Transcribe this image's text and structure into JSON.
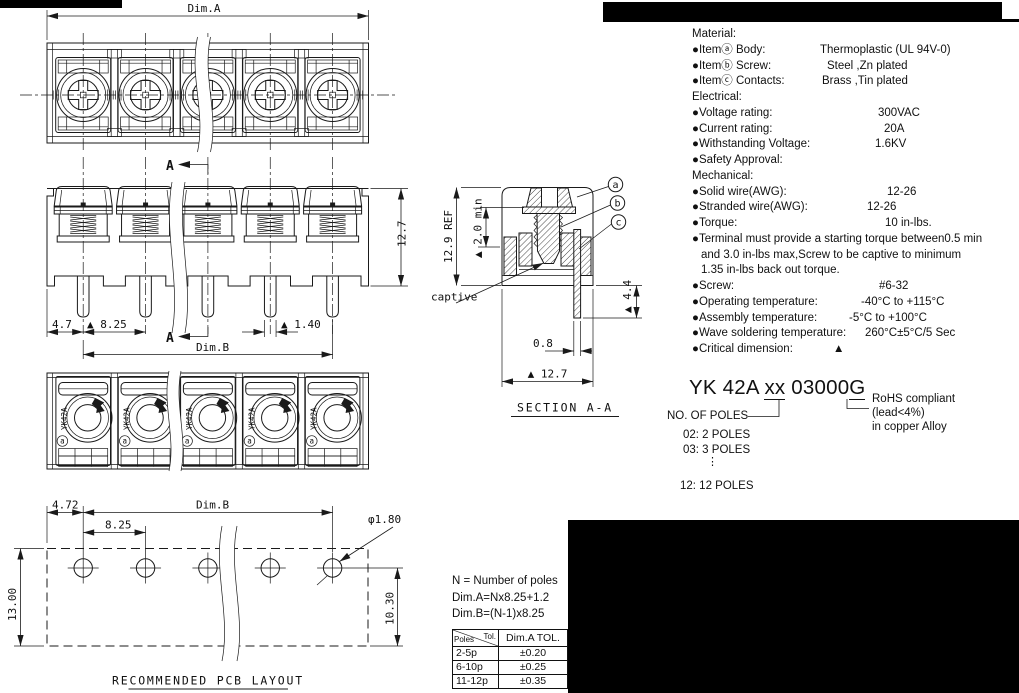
{
  "colors": {
    "line": "#1a1a1a",
    "background": "#ffffff",
    "redaction": "#000000"
  },
  "front_view": {
    "dim_a": "Dim.A"
  },
  "side_view": {
    "dim_left": "4.7",
    "dim_pitch": "▲ 8.25",
    "dim_pin": "▲ 1.40",
    "dim_b": "Dim.B",
    "dim_height": "12.7",
    "section_letter_top": "A",
    "section_letter_bottom": "A"
  },
  "bottom_view": {
    "marking": "YK42A",
    "callout_a": "a"
  },
  "section_view": {
    "title": "SECTION  A-A",
    "dim_ref": "12.9 REF",
    "dim_min": "▲ 2.0 min",
    "captive_label": "captive",
    "dim_pin_width": "0.8",
    "dim_width": "▲ 12.7",
    "dim_tail": "▲ 4.4",
    "callout_a": "a",
    "callout_b": "b",
    "callout_c": "c"
  },
  "pcb_view": {
    "title": "RECOMMENDED PCB LAYOUT",
    "dim_left": "4.72",
    "dim_b": "Dim.B",
    "dim_pitch": "8.25",
    "dim_hole": "φ1.80",
    "dim_height": "13.00",
    "dim_hole_edge": "10.30"
  },
  "specs": {
    "lines": [
      {
        "label": "Material:",
        "value": ""
      },
      {
        "label": "●Itemⓐ Body:",
        "value": "Thermoplastic (UL 94V-0)"
      },
      {
        "label": "●Itemⓑ Screw:",
        "value": "Steel ,Zn plated"
      },
      {
        "label": "●Itemⓒ Contacts:",
        "value": "Brass ,Tin plated"
      },
      {
        "label": "Electrical:",
        "value": ""
      },
      {
        "label": "●Voltage rating:",
        "value": "300VAC"
      },
      {
        "label": "●Current rating:",
        "value": "20A"
      },
      {
        "label": "●Withstanding Voltage:",
        "value": "1.6KV"
      },
      {
        "label": "●Safety Approval:",
        "value": ""
      },
      {
        "label": "Mechanical:",
        "value": ""
      },
      {
        "label": "●Solid wire(AWG):",
        "value": "12-26"
      },
      {
        "label": "●Stranded wire(AWG):",
        "value": "12-26"
      },
      {
        "label": "●Torque:",
        "value": "10 in-lbs."
      },
      {
        "label": "●Terminal must provide a starting torque between0.5 min",
        "value": ""
      },
      {
        "label": "and 3.0 in-lbs max,Screw to be captive to minimum",
        "value": ""
      },
      {
        "label": "1.35 in-lbs back out torque.",
        "value": ""
      },
      {
        "label": "●Screw:",
        "value": "#6-32"
      },
      {
        "label": "●Operating temperature:",
        "value": "-40°C to +115°C"
      },
      {
        "label": "●Assembly temperature:",
        "value": "-5°C to +100°C"
      },
      {
        "label": "●Wave soldering temperature:",
        "value": "260°C±5°C/5 Sec"
      },
      {
        "label": "●Critical dimension:",
        "value": "▲"
      }
    ]
  },
  "part_number": {
    "base": "YK 42A ",
    "poles_code": "xx",
    "mid": " 03000",
    "rohs_code": "G"
  },
  "poles_key": {
    "label": "NO. OF POLES",
    "option_1": "02: 2 POLES",
    "option_2": "03: 3 POLES",
    "ellipsis": "⋮",
    "option_last": "12: 12 POLES"
  },
  "rohs_note": {
    "line1": "RoHS compliant",
    "line2": "(lead<4%)",
    "line3": "in copper Alloy"
  },
  "notes": {
    "line1": "N = Number of poles",
    "line2": "Dim.A=Nx8.25+1.2",
    "line3": "Dim.B=(N-1)x8.25"
  },
  "tolerance_table": {
    "header_diag_top": "Tol.",
    "header_diag_bottom": "Poles",
    "header_col": "Dim.A TOL.",
    "rows": [
      {
        "poles": "2-5p",
        "tol": "±0.20"
      },
      {
        "poles": "6-10p",
        "tol": "±0.25"
      },
      {
        "poles": "11-12p",
        "tol": "±0.35"
      }
    ]
  }
}
